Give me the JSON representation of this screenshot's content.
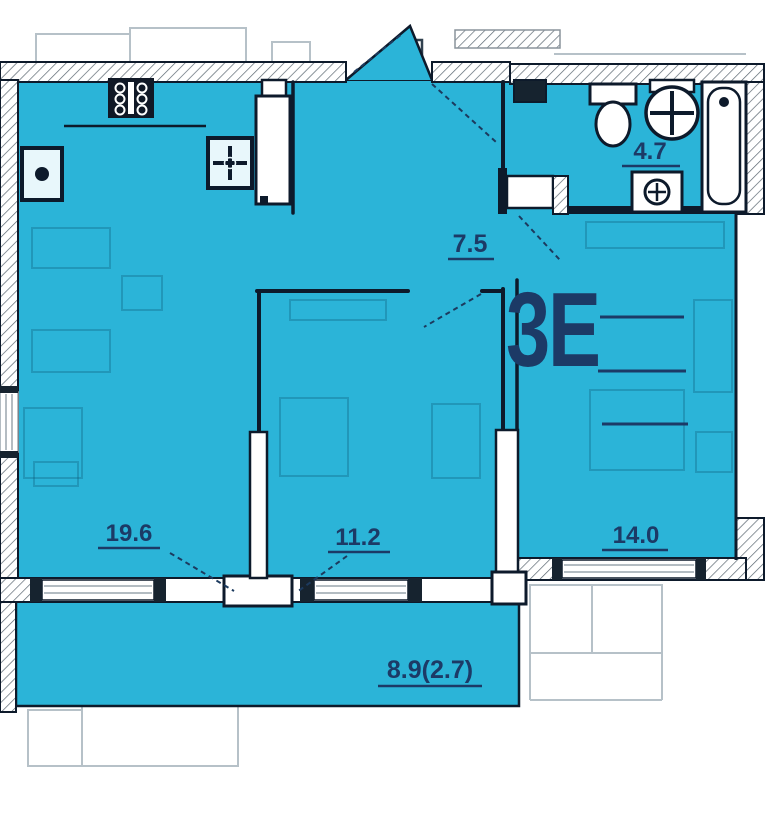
{
  "apartment": {
    "type_label": "3Е",
    "area_upper": "25,20",
    "area_middle": "57,00",
    "area_lower": "59,70"
  },
  "rooms": {
    "living_kitchen": "19.6",
    "bedroom_mid": "11.2",
    "bedroom_right": "14.0",
    "hall": "7.5",
    "bathroom": "4.7",
    "balcony": "8.9(2.7)"
  },
  "fixtures": {
    "stove": "stove",
    "cooktop": "cooktop",
    "sink": "kitchen-sink",
    "fridge": "fridge",
    "toilet": "toilet",
    "washbasin": "washbasin",
    "bathtub": "bathtub",
    "washing_machine": "washing-machine"
  },
  "colors": {
    "floor": "#2bb4d8",
    "wall": "#0d1a2b",
    "label": "#1c3a66",
    "outside_faint": "#b6c1c8",
    "background": "#ffffff"
  }
}
